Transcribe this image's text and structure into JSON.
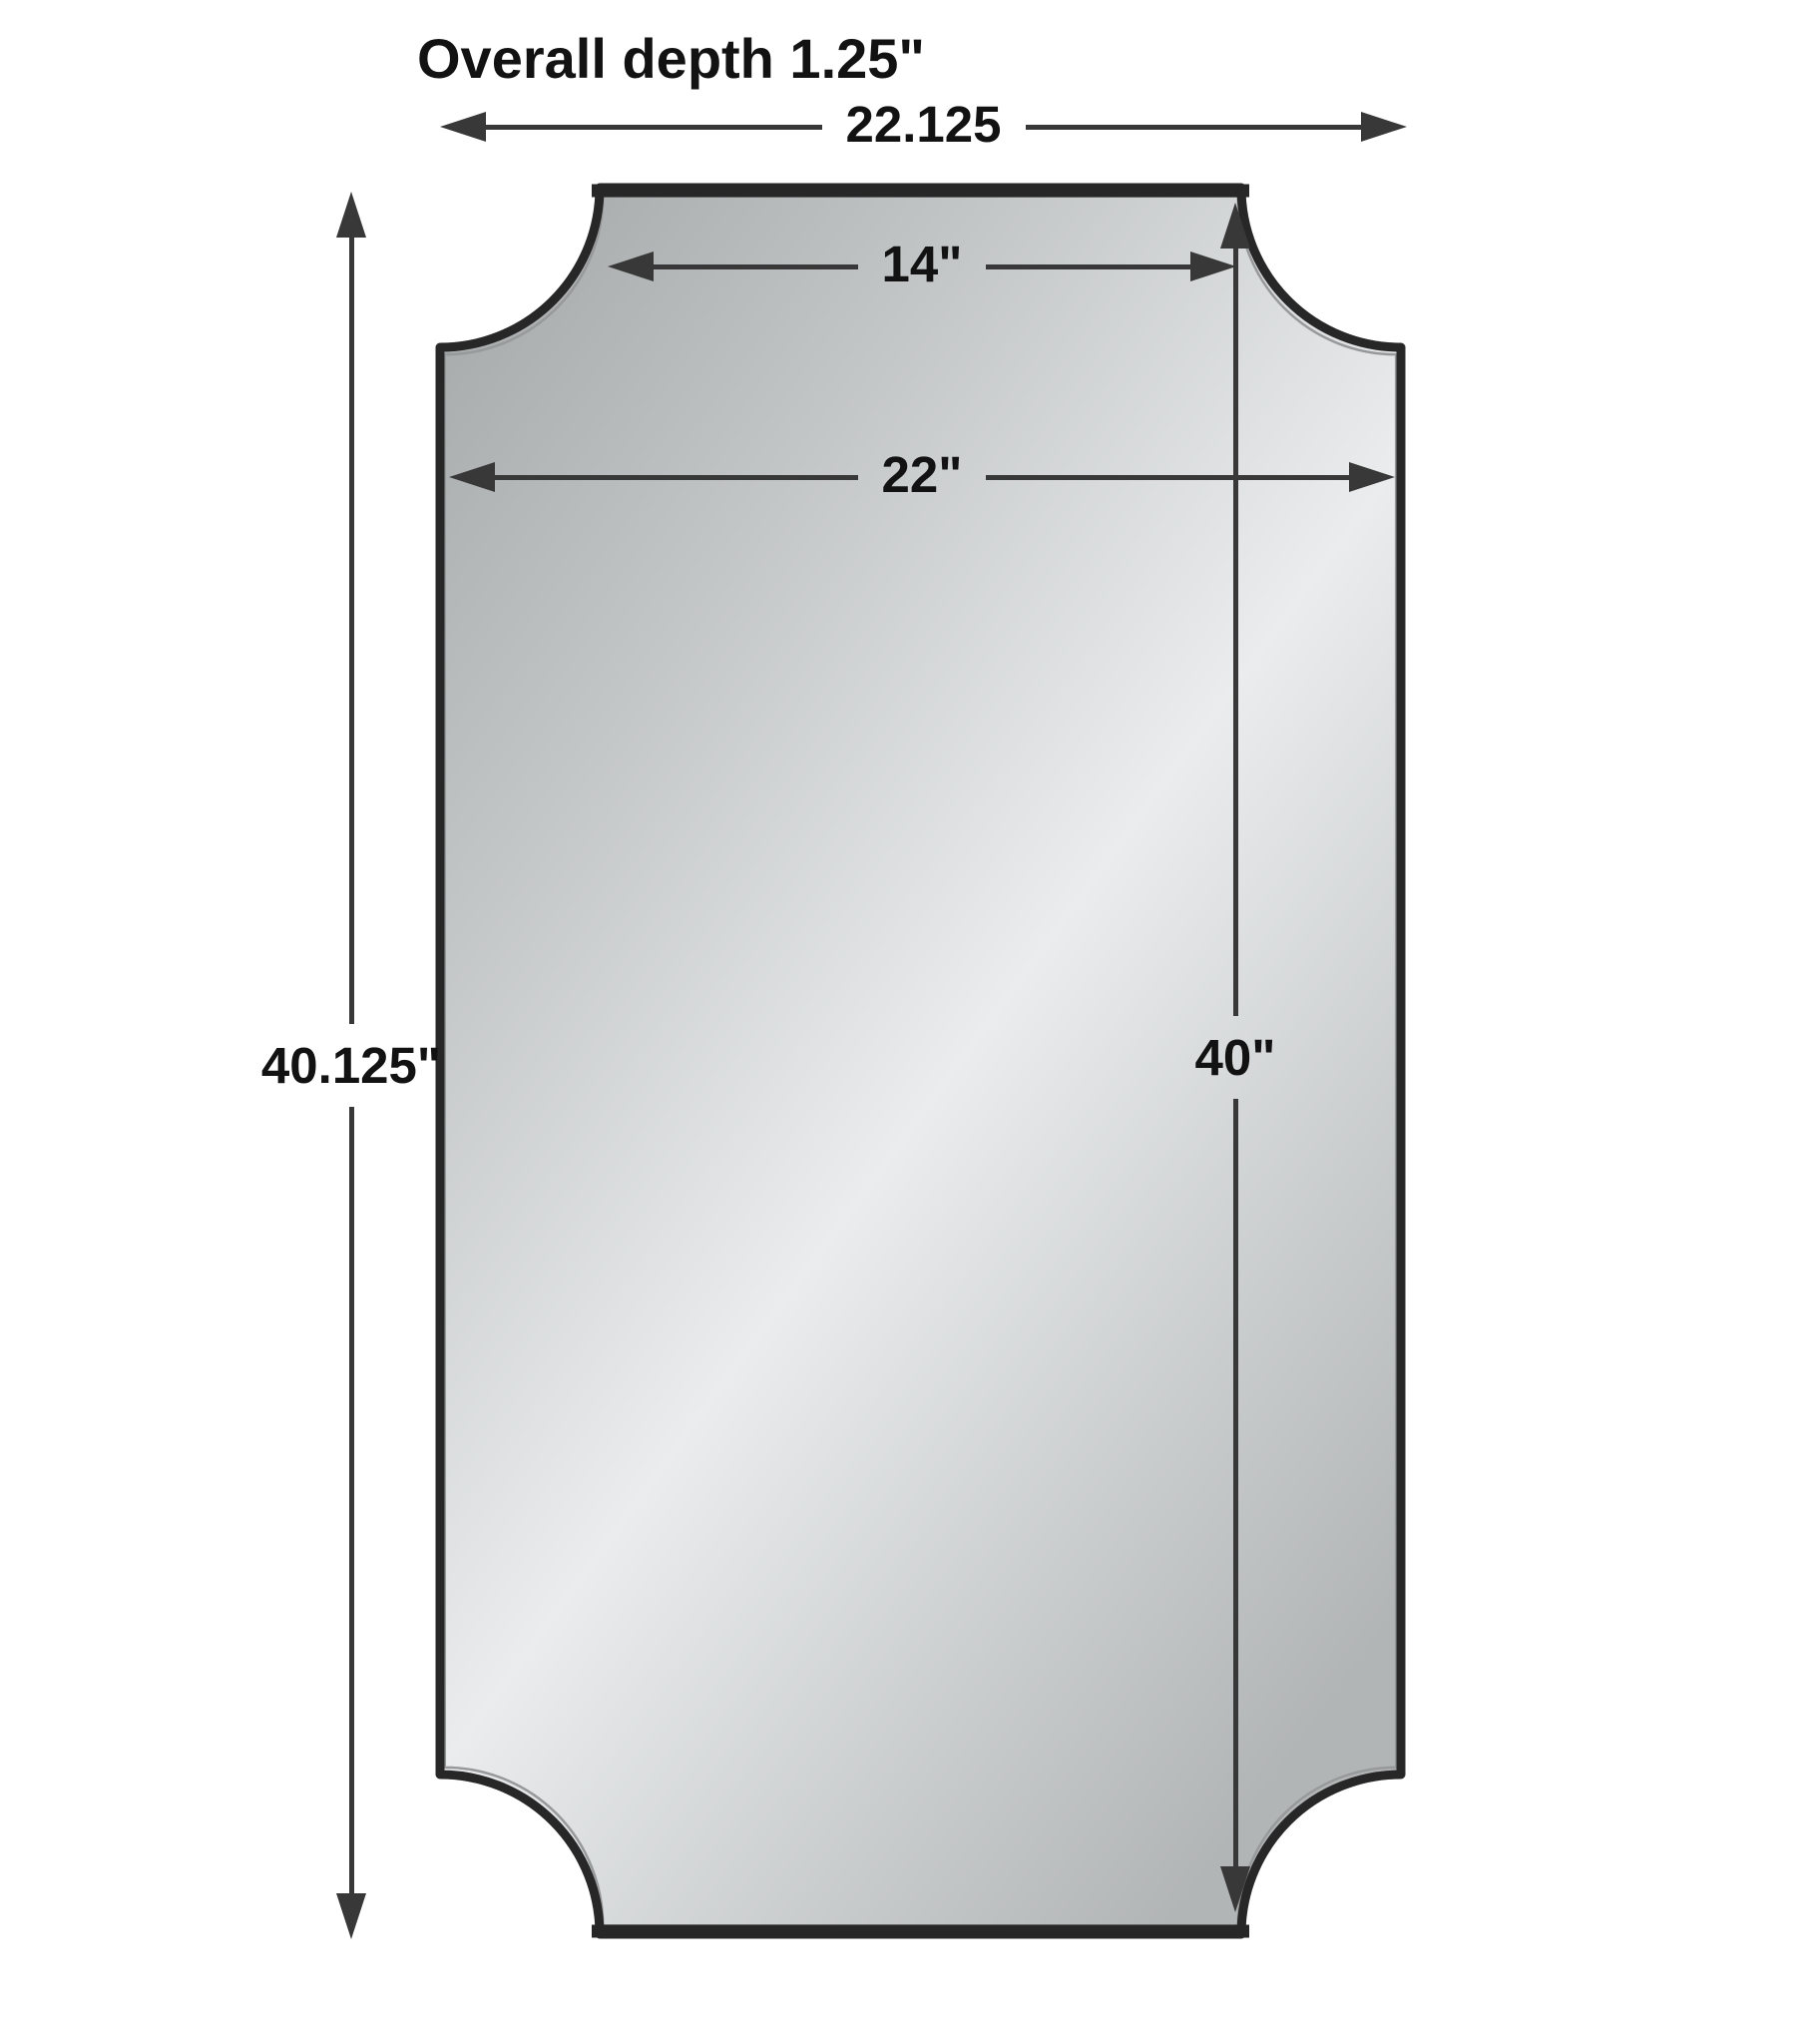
{
  "title": "Overall depth 1.25\"",
  "diagram": {
    "type": "product-dimension-diagram",
    "object": "rectangular mirror with concave scalloped corners, thin dark metal frame",
    "dimensions": {
      "overall_width": {
        "name": "overall width",
        "label": "22.125"
      },
      "top_edge_width": {
        "name": "top edge width",
        "label": "14\""
      },
      "inner_width": {
        "name": "mirror glass width",
        "label": "22\""
      },
      "overall_height": {
        "name": "overall height",
        "label": "40.125\""
      },
      "inner_height": {
        "name": "mirror glass height",
        "label": "40\""
      },
      "overall_depth": {
        "name": "overall depth",
        "label": "1.25\""
      }
    },
    "colors": {
      "background": "#ffffff",
      "frame": "#272727",
      "frame_highlight": "#97999a",
      "dimension_lines": "#383838",
      "text": "#121212",
      "glass_dark": "#a2a6a7",
      "glass_mid": "#c3c6c7",
      "glass_light": "#eaeced",
      "glass_bottom": "#b2b5b6"
    }
  }
}
